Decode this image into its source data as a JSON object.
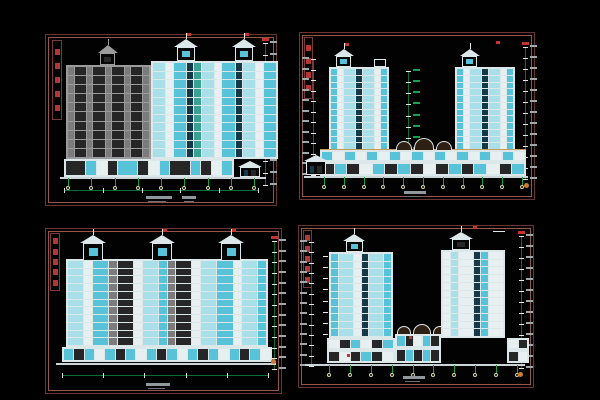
{
  "palette": {
    "a": "#a9dfe9",
    "b": "#58c2d8",
    "c": "#27819d",
    "d": "#16394a",
    "e": "#e7eff1",
    "g": "#7b7b7b",
    "h": "#262626",
    "t": "#39a092",
    "n": "#0d2a4a",
    "grayFrame": "#9b9b9b",
    "whiteFrame": "#dce7e9",
    "green": "#16a14b",
    "dimgreen": "#0c6e33",
    "red": "#c63232",
    "orange": "#cf7a2e",
    "tan": "#c59a5f",
    "text": "#9fa8ac",
    "titleRed": "#b23838",
    "ground": "#ccd6d8",
    "bubble": "#cfd3a8"
  },
  "panels": [
    {
      "name": "sheet-north-elevation",
      "x": 45,
      "y": 34,
      "w": 232,
      "h": 172,
      "title_strip": {
        "x": 6,
        "y": 5,
        "w": 10,
        "h": 80,
        "glyphs": 5
      },
      "features": [
        {
          "kind": "dimv",
          "name": "right-level-dimension-string",
          "x": 219,
          "y1": 8,
          "y2": 150,
          "ticks": 13,
          "side": "right",
          "red": true
        },
        {
          "kind": "facade",
          "name": "gray-side-wing-elevation",
          "x": 20,
          "y": 30,
          "w": 85,
          "h": 94,
          "floors": 10,
          "frame": "grayFrame",
          "bays": [
            "g:1",
            "h:2",
            "g:1",
            "h:2",
            "g:1",
            "h:2",
            "g:1",
            "h:2",
            "g:1"
          ]
        },
        {
          "kind": "pavilion",
          "name": "gray-roof-penthouse",
          "x": 52,
          "y": 10,
          "w": 20,
          "h": 20,
          "c": "grayFrame",
          "cell": "h",
          "antenna": true,
          "flag": false
        },
        {
          "kind": "facade",
          "name": "main-facade-elevation",
          "x": 105,
          "y": 26,
          "w": 127,
          "h": 98,
          "floors": 11,
          "frame": "whiteFrame",
          "bays": [
            "a:2",
            "e:1",
            "b:2",
            "d:1",
            "t:1",
            "a:2",
            "e:1",
            "b:2",
            "d:1",
            "a:2",
            "e:1",
            "b:2"
          ]
        },
        {
          "kind": "pavilion",
          "name": "roof-pavilion-left",
          "x": 128,
          "y": 4,
          "w": 24,
          "h": 22,
          "c": "whiteFrame",
          "cell": "b",
          "antenna": true,
          "flag": true
        },
        {
          "kind": "pavilion",
          "name": "roof-pavilion-right",
          "x": 186,
          "y": 4,
          "w": 24,
          "h": 22,
          "c": "whiteFrame",
          "cell": "b",
          "antenna": true,
          "flag": true
        },
        {
          "kind": "facade",
          "name": "storefront-row",
          "x": 18,
          "y": 124,
          "w": 170,
          "h": 18,
          "floors": 1,
          "frame": "whiteFrame",
          "bays": [
            "h:2",
            "b:1",
            "e:1",
            "h:1",
            "b:2",
            "h:1",
            "e:1",
            "b:1",
            "h:2",
            "b:1",
            "h:1",
            "e:1",
            "b:1"
          ]
        },
        {
          "kind": "house",
          "name": "entrance-gatehouse",
          "x": 192,
          "y": 126,
          "w": 24,
          "h": 16
        },
        {
          "kind": "ground",
          "name": "ground-line",
          "x1": 14,
          "x2": 220,
          "y": 142
        },
        {
          "kind": "grid",
          "name": "column-grid-bubbles",
          "x1": 22,
          "x2": 208,
          "y": 143,
          "h": 8,
          "count": 9
        },
        {
          "kind": "dimh",
          "name": "bottom-dimension-line",
          "x1": 18,
          "x2": 212,
          "y": 155,
          "ticks": 6
        },
        {
          "kind": "note",
          "name": "drawing-title-text",
          "x": 100,
          "y": 161,
          "w": 26
        },
        {
          "kind": "note",
          "name": "drawing-scale-text",
          "x": 136,
          "y": 161,
          "w": 14
        }
      ]
    },
    {
      "name": "sheet-side-elevation-towers",
      "x": 299,
      "y": 32,
      "w": 236,
      "h": 168,
      "title_strip": {
        "x": 4,
        "y": 4,
        "w": 9,
        "h": 62,
        "glyphs": 4
      },
      "features": [
        {
          "kind": "dimv",
          "name": "left-level-dimension-string",
          "x": 13,
          "y1": 26,
          "y2": 142,
          "ticks": 12,
          "side": "left",
          "red": false
        },
        {
          "kind": "dimv",
          "name": "right-level-dimension-string",
          "x": 225,
          "y1": 14,
          "y2": 146,
          "ticks": 13,
          "side": "right",
          "red": true
        },
        {
          "kind": "dimv",
          "name": "center-grid-leaders",
          "x": 108,
          "y1": 38,
          "y2": 116,
          "ticks": 8,
          "side": "right",
          "lc": "green",
          "red": false
        },
        {
          "kind": "facade",
          "name": "left-tower-elevation",
          "x": 29,
          "y": 34,
          "w": 60,
          "h": 84,
          "floors": 12,
          "frame": "whiteFrame",
          "bays": [
            "b:1",
            "e:1",
            "a:2",
            "d:1",
            "a:2",
            "e:1",
            "b:1"
          ]
        },
        {
          "kind": "pavilion",
          "name": "left-tower-penthouse",
          "x": 34,
          "y": 16,
          "w": 20,
          "h": 18,
          "c": "whiteFrame",
          "cell": "b",
          "antenna": true,
          "flag": true
        },
        {
          "kind": "mark",
          "name": "left-tower-roof-box",
          "x": 74,
          "y": 26,
          "w": 12,
          "h": 8,
          "c": "whiteFrame",
          "hollow": true
        },
        {
          "kind": "facade",
          "name": "right-tower-elevation",
          "x": 155,
          "y": 34,
          "w": 60,
          "h": 84,
          "floors": 12,
          "frame": "whiteFrame",
          "bays": [
            "b:1",
            "e:1",
            "a:2",
            "d:1",
            "a:2",
            "e:1",
            "b:1"
          ]
        },
        {
          "kind": "pavilion",
          "name": "right-tower-penthouse",
          "x": 160,
          "y": 16,
          "w": 20,
          "h": 18,
          "c": "whiteFrame",
          "cell": "b",
          "antenna": true,
          "flag": false
        },
        {
          "kind": "mark",
          "name": "right-tower-flag",
          "x": 196,
          "y": 8,
          "w": 4,
          "h": 3,
          "c": "red"
        },
        {
          "kind": "mark",
          "name": "podium-cornice-line",
          "x": 20,
          "y": 116,
          "w": 206,
          "h": 1,
          "c": "tan"
        },
        {
          "kind": "facade",
          "name": "podium-awning-row",
          "x": 20,
          "y": 117,
          "w": 206,
          "h": 12,
          "floors": 1,
          "frame": "whiteFrame",
          "bays": [
            "b:1",
            "e:1",
            "b:1",
            "e:1",
            "b:1",
            "e:1",
            "b:1",
            "e:1",
            "b:1",
            "e:1",
            "b:1",
            "e:1",
            "b:1",
            "e:1",
            "b:1",
            "e:1",
            "b:1",
            "e:1"
          ]
        },
        {
          "kind": "facade",
          "name": "podium-shop-row",
          "x": 20,
          "y": 129,
          "w": 206,
          "h": 14,
          "floors": 1,
          "frame": "whiteFrame",
          "bays": [
            "h:1",
            "b:1",
            "h:1",
            "e:1",
            "b:1",
            "h:1",
            "b:1",
            "h:1",
            "e:1",
            "h:1",
            "b:1",
            "h:1",
            "b:1",
            "e:1",
            "h:1",
            "b:1"
          ]
        },
        {
          "kind": "arch",
          "name": "podium-arched-canopy-left",
          "x": 96,
          "y": 108,
          "w": 16,
          "h": 9
        },
        {
          "kind": "arch",
          "name": "podium-arched-canopy-center",
          "x": 114,
          "y": 105,
          "w": 20,
          "h": 12
        },
        {
          "kind": "arch",
          "name": "podium-arched-canopy-right",
          "x": 136,
          "y": 108,
          "w": 16,
          "h": 9
        },
        {
          "kind": "house",
          "name": "gate-house",
          "x": 4,
          "y": 122,
          "w": 24,
          "h": 20
        },
        {
          "kind": "ground",
          "name": "ground-line",
          "x1": 4,
          "x2": 228,
          "y": 143
        },
        {
          "kind": "grid",
          "name": "column-grid-bubbles",
          "x1": 24,
          "x2": 222,
          "y": 144,
          "h": 8,
          "count": 11
        },
        {
          "kind": "mark",
          "name": "detail-bubble",
          "x": 224,
          "y": 150,
          "w": 5,
          "h": 5,
          "c": "orange",
          "round": true
        },
        {
          "kind": "note",
          "name": "drawing-title-text",
          "x": 104,
          "y": 158,
          "w": 22
        }
      ]
    },
    {
      "name": "sheet-south-elevation",
      "x": 45,
      "y": 228,
      "w": 237,
      "h": 166,
      "title_strip": {
        "x": 4,
        "y": 4,
        "w": 10,
        "h": 58,
        "glyphs": 5
      },
      "features": [
        {
          "kind": "dimv",
          "name": "right-level-dimension-string",
          "x": 228,
          "y1": 12,
          "y2": 140,
          "ticks": 13,
          "side": "right",
          "red": true
        },
        {
          "kind": "facade",
          "name": "main-slab-elevation",
          "x": 20,
          "y": 30,
          "w": 202,
          "h": 88,
          "floors": 11,
          "frame": "whiteFrame",
          "bays": [
            "a:2",
            "e:1",
            "b:2",
            "g:1",
            "h:2",
            "e:1",
            "a:2",
            "b:1",
            "g:1",
            "h:2",
            "e:1",
            "a:2",
            "b:2",
            "e:1",
            "a:2",
            "b:1"
          ]
        },
        {
          "kind": "pavilion",
          "name": "roof-pavilion-left",
          "x": 34,
          "y": 6,
          "w": 26,
          "h": 26,
          "c": "whiteFrame",
          "cell": "b",
          "antenna": true,
          "flag": false
        },
        {
          "kind": "pavilion",
          "name": "roof-pavilion-center",
          "x": 103,
          "y": 6,
          "w": 26,
          "h": 26,
          "c": "whiteFrame",
          "cell": "b",
          "antenna": true,
          "flag": true
        },
        {
          "kind": "pavilion",
          "name": "roof-pavilion-right",
          "x": 172,
          "y": 6,
          "w": 26,
          "h": 26,
          "c": "whiteFrame",
          "cell": "b",
          "antenna": true,
          "flag": true
        },
        {
          "kind": "facade",
          "name": "arcade-storefront-row",
          "x": 16,
          "y": 118,
          "w": 210,
          "h": 15,
          "floors": 1,
          "frame": "whiteFrame",
          "bays": [
            "b:1",
            "h:1",
            "b:1",
            "e:1",
            "b:1",
            "h:1",
            "b:1",
            "e:1",
            "b:1",
            "h:1",
            "b:1",
            "e:1",
            "b:1",
            "h:1",
            "b:1",
            "e:1",
            "b:1",
            "h:1",
            "b:1",
            "e:1"
          ]
        },
        {
          "kind": "ground",
          "name": "ground-line",
          "x1": 10,
          "x2": 230,
          "y": 134
        },
        {
          "kind": "dimh",
          "name": "bottom-dimension-line",
          "x1": 16,
          "x2": 222,
          "y": 146,
          "ticks": 6
        },
        {
          "kind": "mark",
          "name": "detail-bubble",
          "x": 225,
          "y": 130,
          "w": 5,
          "h": 5,
          "c": "orange",
          "round": true
        },
        {
          "kind": "note",
          "name": "drawing-title-text",
          "x": 100,
          "y": 154,
          "w": 24
        }
      ]
    },
    {
      "name": "sheet-section-elevation-towers",
      "x": 298,
      "y": 225,
      "w": 236,
      "h": 163,
      "title_strip": {
        "x": 4,
        "y": 4,
        "w": 9,
        "h": 58,
        "glyphs": 5
      },
      "features": [
        {
          "kind": "dimv",
          "name": "left-level-dimension-string",
          "x": 12,
          "y1": 16,
          "y2": 140,
          "ticks": 13,
          "side": "left",
          "red": false
        },
        {
          "kind": "dimv",
          "name": "left-inner-tick-column",
          "x": 26,
          "y1": 30,
          "y2": 108,
          "ticks": 8,
          "side": "right",
          "noline": true,
          "red": false
        },
        {
          "kind": "dimv",
          "name": "right-level-dimension-string",
          "x": 222,
          "y1": 10,
          "y2": 142,
          "ticks": 13,
          "side": "right",
          "red": true
        },
        {
          "kind": "facade",
          "name": "left-tower-elevation",
          "x": 30,
          "y": 26,
          "w": 64,
          "h": 86,
          "floors": 11,
          "frame": "whiteFrame",
          "bays": [
            "b:1",
            "a:2",
            "e:1",
            "d:1",
            "a:2",
            "b:1"
          ]
        },
        {
          "kind": "pavilion",
          "name": "left-tower-penthouse",
          "x": 44,
          "y": 8,
          "w": 22,
          "h": 18,
          "c": "whiteFrame",
          "cell": "b",
          "antenna": true,
          "flag": false
        },
        {
          "kind": "facade",
          "name": "left-tower-base",
          "x": 28,
          "y": 112,
          "w": 68,
          "h": 12,
          "floors": 1,
          "frame": "whiteFrame",
          "bays": [
            "e:1",
            "h:1",
            "b:1",
            "e:1",
            "h:1",
            "b:1"
          ]
        },
        {
          "kind": "facade",
          "name": "left-tower-base-lower",
          "x": 28,
          "y": 124,
          "w": 68,
          "h": 13,
          "floors": 1,
          "frame": "whiteFrame",
          "bays": [
            "h:1",
            "e:1",
            "h:1",
            "b:1",
            "h:1",
            "e:1"
          ]
        },
        {
          "kind": "arch",
          "name": "podium-arch-left",
          "x": 98,
          "y": 100,
          "w": 14,
          "h": 8
        },
        {
          "kind": "arch",
          "name": "podium-arch-center",
          "x": 114,
          "y": 98,
          "w": 18,
          "h": 10
        },
        {
          "kind": "arch",
          "name": "podium-arch-right",
          "x": 134,
          "y": 100,
          "w": 14,
          "h": 8
        },
        {
          "kind": "facade",
          "name": "mid-podium-upper",
          "x": 96,
          "y": 108,
          "w": 46,
          "h": 14,
          "floors": 1,
          "frame": "whiteFrame",
          "bays": [
            "b:1",
            "h:1",
            "e:1",
            "b:1",
            "h:1"
          ]
        },
        {
          "kind": "facade",
          "name": "mid-podium-lower",
          "x": 96,
          "y": 122,
          "w": 46,
          "h": 15,
          "floors": 1,
          "frame": "whiteFrame",
          "bays": [
            "h:1",
            "b:1",
            "h:1",
            "b:1",
            "h:1"
          ]
        },
        {
          "kind": "facade",
          "name": "right-tower-elevation",
          "x": 142,
          "y": 24,
          "w": 64,
          "h": 88,
          "floors": 11,
          "frame": "whiteFrame",
          "bays": [
            "e:1",
            "a:1",
            "e:2",
            "d:1",
            "b:1",
            "e:2"
          ]
        },
        {
          "kind": "pavilion",
          "name": "right-tower-roof-box",
          "x": 150,
          "y": 6,
          "w": 24,
          "h": 18,
          "c": "whiteFrame",
          "cell": "h",
          "antenna": true,
          "flag": false
        },
        {
          "kind": "mark",
          "name": "roof-mast-flag",
          "x": 174,
          "y": 0,
          "w": 4,
          "h": 3,
          "c": "red"
        },
        {
          "kind": "mark",
          "name": "roof-antenna-bar",
          "x": 194,
          "y": 5,
          "w": 12,
          "h": 1,
          "c": "whiteFrame"
        },
        {
          "kind": "facade",
          "name": "right-annex-upper",
          "x": 208,
          "y": 112,
          "w": 22,
          "h": 12,
          "floors": 1,
          "frame": "whiteFrame",
          "bays": [
            "e:1",
            "h:1"
          ]
        },
        {
          "kind": "facade",
          "name": "right-annex-lower",
          "x": 208,
          "y": 124,
          "w": 22,
          "h": 13,
          "floors": 1,
          "frame": "whiteFrame",
          "bays": [
            "h:1",
            "e:1"
          ]
        },
        {
          "kind": "ground",
          "name": "ground-line",
          "x1": 6,
          "x2": 226,
          "y": 138
        },
        {
          "kind": "grid",
          "name": "column-grid-bubbles",
          "x1": 30,
          "x2": 218,
          "y": 139,
          "h": 8,
          "count": 10
        },
        {
          "kind": "mark",
          "name": "base-flag-left",
          "x": 48,
          "y": 128,
          "w": 3,
          "h": 3,
          "c": "red"
        },
        {
          "kind": "mark",
          "name": "podium-flag",
          "x": 110,
          "y": 110,
          "w": 3,
          "h": 3,
          "c": "red"
        },
        {
          "kind": "mark",
          "name": "detail-bubble",
          "x": 219,
          "y": 146,
          "w": 5,
          "h": 5,
          "c": "orange",
          "round": true
        },
        {
          "kind": "note",
          "name": "drawing-title-text",
          "x": 104,
          "y": 150,
          "w": 22
        }
      ]
    }
  ]
}
